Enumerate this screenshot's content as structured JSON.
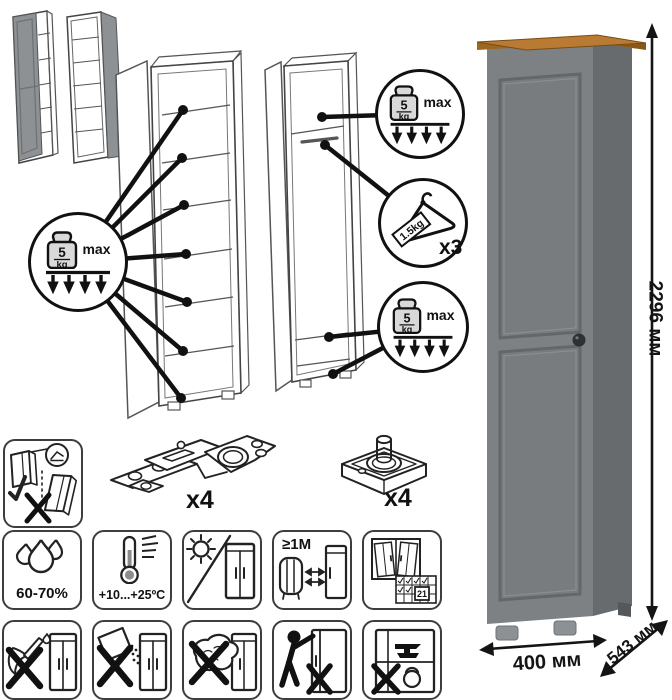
{
  "colors": {
    "line": "#222222",
    "wardrobe_front": "#7e8184",
    "wardrobe_side": "#686b6e",
    "wardrobe_panel": "#797c7f",
    "wood_top": "#b97b33",
    "wood_edge": "#9c671f",
    "knob": "#2e3134",
    "thumb_door_gray": "#8e9194"
  },
  "callouts": {
    "shelf": {
      "value": "5",
      "unit": "kg",
      "max_label": "max"
    },
    "top": {
      "value": "5",
      "unit": "kg",
      "max_label": "max"
    },
    "bottom": {
      "value": "5",
      "unit": "kg",
      "max_label": "max"
    },
    "hanger": {
      "load": "1.5kg",
      "qty": "x3"
    }
  },
  "hardware": {
    "hinge_qty": "x4",
    "foot_qty": "x4"
  },
  "dimensions": {
    "height": "2296 мм",
    "width": "400 мм",
    "depth": "543 мм"
  },
  "care": {
    "humidity": "60-70%",
    "temperature": "+10...+25ºC",
    "min_distance": "≥1М",
    "calendar_day": "21"
  }
}
